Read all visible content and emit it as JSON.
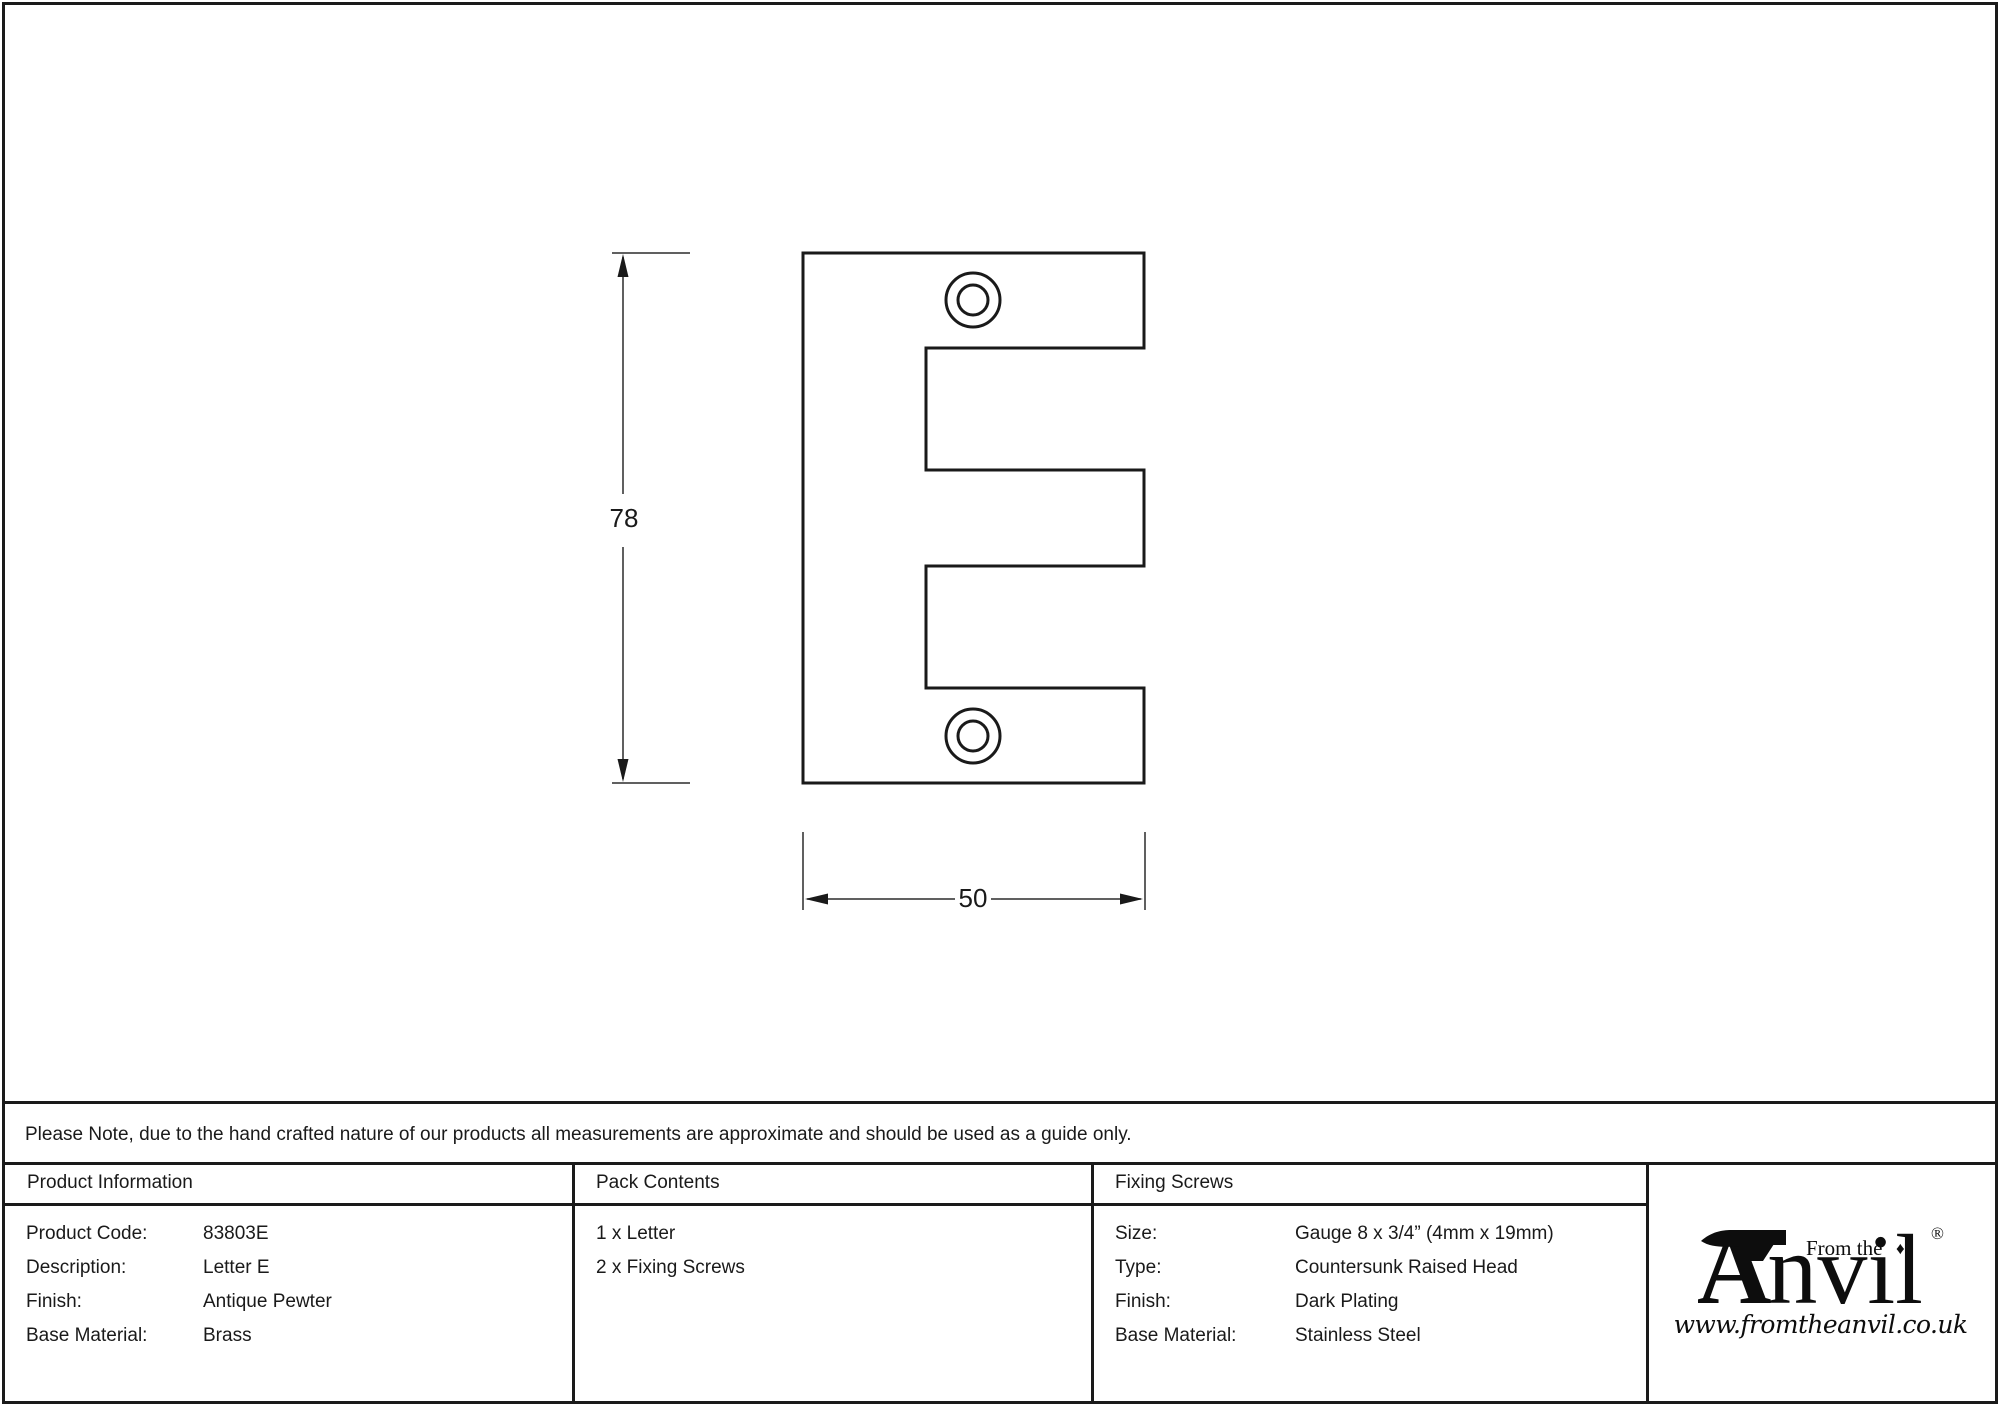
{
  "drawing": {
    "height_dimension": "78",
    "width_dimension": "50"
  },
  "note": {
    "text": "Please Note, due to the hand crafted nature of our products all measurements are approximate and should be used as a guide only."
  },
  "product_information": {
    "header": "Product Information",
    "rows": [
      {
        "label": "Product Code:",
        "value": "83803E"
      },
      {
        "label": "Description:",
        "value": "Letter E"
      },
      {
        "label": "Finish:",
        "value": "Antique Pewter"
      },
      {
        "label": "Base Material:",
        "value": "Brass"
      }
    ]
  },
  "pack_contents": {
    "header": "Pack Contents",
    "items": [
      "1 x Letter",
      "2 x Fixing Screws"
    ]
  },
  "fixing_screws": {
    "header": "Fixing Screws",
    "rows": [
      {
        "label": "Size:",
        "value": "Gauge 8 x 3/4” (4mm x 19mm)"
      },
      {
        "label": "Type:",
        "value": "Countersunk Raised Head"
      },
      {
        "label": "Finish:",
        "value": "Dark Plating"
      },
      {
        "label": "Base Material:",
        "value": "Stainless Steel"
      }
    ]
  },
  "logo": {
    "prefix": "From the",
    "brand_initial": "A",
    "brand_rest": "nvil",
    "diamond": "♦",
    "registered": "®",
    "website": "www.fromtheanvil.co.uk"
  }
}
